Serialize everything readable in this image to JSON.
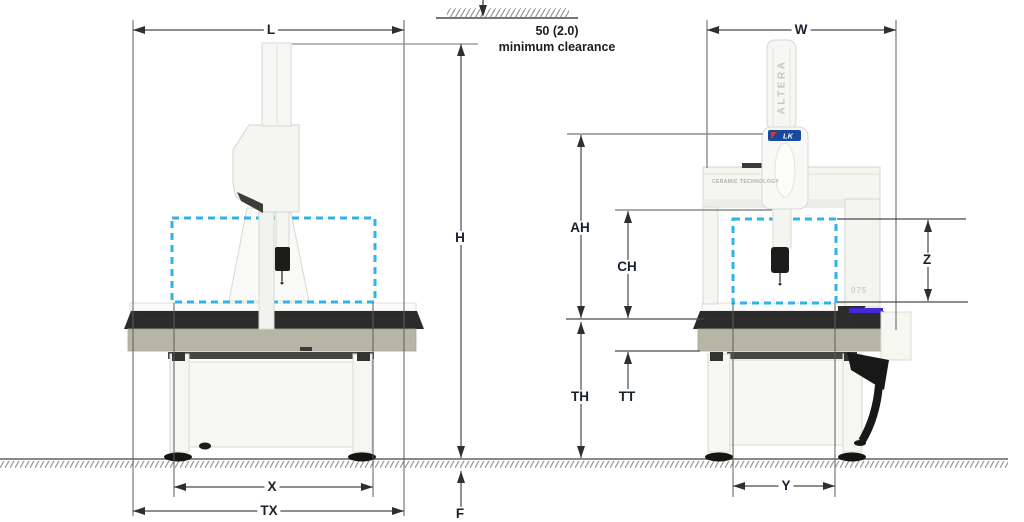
{
  "diagram": {
    "type": "cmm-installation-dimension-drawing",
    "clearance": {
      "value": "50 (2.0)",
      "note": "minimum clearance"
    },
    "labels": {
      "L": "L",
      "H": "H",
      "X": "X",
      "TX": "TX",
      "F": "F",
      "W": "W",
      "AH": "AH",
      "CH": "CH",
      "TH": "TH",
      "TT": "TT",
      "Z": "Z",
      "Y": "Y"
    },
    "machine": {
      "brand": "ALTERA",
      "logo": "LK",
      "beam_text": "CERAMIC TECHNOLOGY",
      "model": "075"
    },
    "colors": {
      "dimension_line": "#4a4a4a",
      "reference_line": "#8d8d8d",
      "label_text": "#17212e",
      "envelope_dashed": "#2fb3e8",
      "granite": "#b6b6a7",
      "table_top": "#2b2b2b",
      "machine_body": "#f6f6f3",
      "machine_stroke": "#d6d6d0",
      "accent_strip": "#4526d8",
      "logo_blue": "#1a4a9e",
      "ground": "#8a8a8a"
    }
  }
}
